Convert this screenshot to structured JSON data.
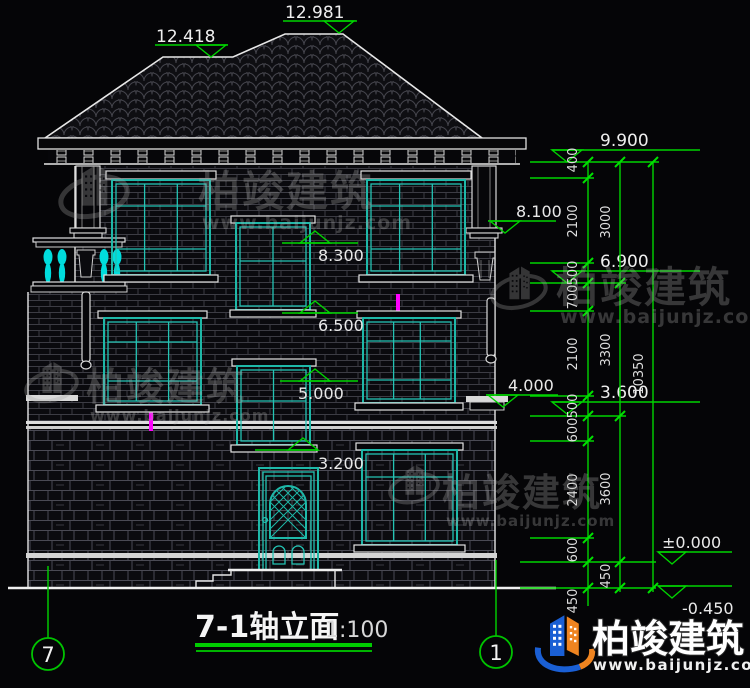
{
  "drawing": {
    "title": "7-1轴立面",
    "scale": "1:100",
    "axis_left": "7",
    "axis_right": "1"
  },
  "levels": {
    "ridge_low": "12.418",
    "ridge_high": "12.981",
    "eave": "9.900",
    "balcony_col_top": "8.100",
    "win3_head": "8.300",
    "floor3": "6.900",
    "win2_head": "6.500",
    "stair_win_head": "5.000",
    "pier_cap": "4.000",
    "floor2": "3.600",
    "win1_head": "3.200",
    "ground_floor": "±0.000",
    "site": "-0.450"
  },
  "dim_col1": [
    "400",
    "2100",
    "500",
    "700",
    "2100",
    "500",
    "600",
    "2400",
    "600",
    "450"
  ],
  "dim_col2": [
    "3000",
    "3300",
    "3600",
    "450"
  ],
  "dim_col3": [
    "10350"
  ],
  "watermark": {
    "brand": "柏竣建筑",
    "site": "www.baijunjz.com"
  },
  "colors": {
    "dimension_green": "#00d400",
    "window_teal": "#1eb8a8",
    "downpipe_magenta": "#ff00ff",
    "logo_blue": "#1a5fd4",
    "logo_orange": "#ef8420"
  }
}
